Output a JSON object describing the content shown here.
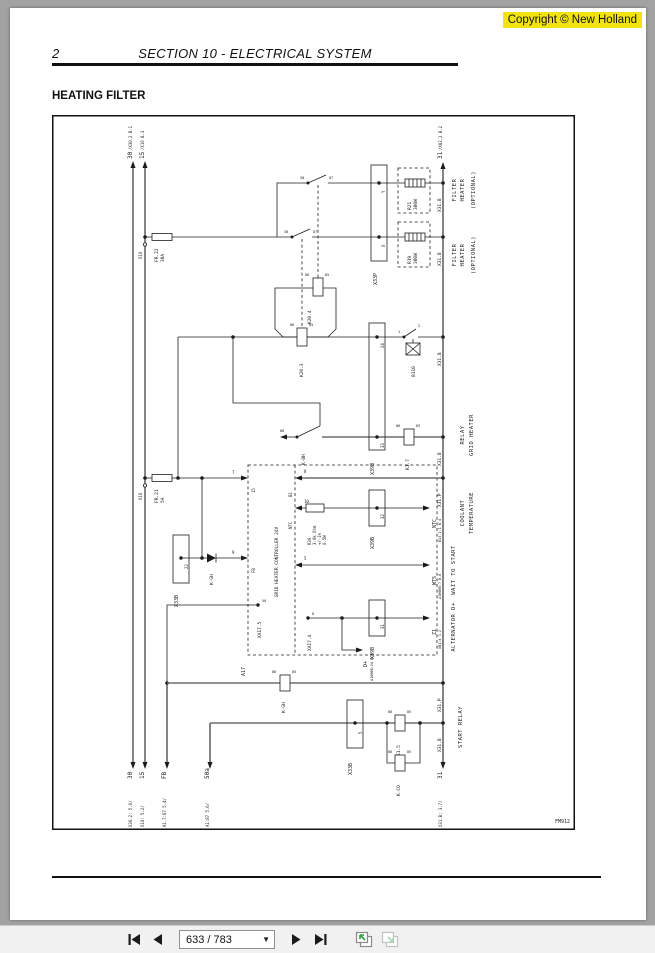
{
  "viewer": {
    "copyright": "Copyright © New Holland",
    "toolbar": {
      "page_field": "633 / 783"
    }
  },
  "doc": {
    "page_number": "2",
    "section_title": "SECTION 10 - ELECTRICAL SYSTEM",
    "heading": "HEATING FILTER",
    "figure_id": "FM912"
  },
  "d": {
    "rails": {
      "t30": "30",
      "t30r": "/X30.2 B.1",
      "t15": "15",
      "t15r": "/X10 B.3",
      "t31": "31",
      "t31r": "/X82.2 B.2",
      "b30r": "X30.2: 5.0/",
      "b30": "30",
      "b15r": "X10: 5.2/",
      "b15": "15",
      "bfbr": "A1.7:87 5.4/",
      "bfb": "FB",
      "b50r": "A1:87 5.6/",
      "b50": "50a",
      "b31r": "X31.B: 3.7/",
      "b31": "31"
    },
    "tags": {
      "x31b": "X31.B",
      "x31p": "X31.P",
      "x10": "X10"
    },
    "comp": {
      "fr22a": "FR.22",
      "fr22b": "30A",
      "fr21a": "FR.21",
      "fr21b": "5A",
      "x33p": "X33P",
      "pin_y": "Y",
      "pin_x": "X",
      "r21a": "R21",
      "r21b": "300W",
      "r19a": "R19",
      "r19b": "300W",
      "k20_4": "K20.4",
      "k20_3": "K20.3",
      "b110": "B110",
      "x39b": "X39B",
      "p24": "24",
      "p33": "33",
      "p32": "32",
      "p31": "31",
      "k1_7": "K1.7",
      "kbh": "K-BH",
      "kgh": "K-GH",
      "k1_5": "K1.5",
      "kco": "K-CO",
      "x33b": "X33B",
      "p22": "22",
      "p5": "5",
      "r30a": "R30",
      "r30b": "3.0k Ohm",
      "r30c": "+/-1%",
      "r30d": "0.5W",
      "a17": "A17",
      "ctrl": "GRID HEATER CONTROLLER 24V",
      "xa17_5": "XA17.5",
      "xa17_4": "XA17.4"
    },
    "pins": {
      "p86": "86",
      "p85": "85",
      "c30": "30",
      "c87": "87",
      "b1": "1",
      "b2": "2",
      "n7": "7",
      "n9": "9",
      "n8": "8",
      "n10": "10",
      "n5": "5",
      "s15": "15",
      "sfb": "FB",
      "sb1": "B1",
      "sntc": "NTC",
      "s50": "50",
      "sd": "D"
    },
    "refs": {
      "ntc": "NTC",
      "ntcr": "B13.1:1 B.4",
      "wts": "WTS",
      "wtsr": "A1000B:7 B.8",
      "z1": "Z1",
      "z1r": "XB1:4 3.2",
      "dp": "D+",
      "dpr": "A1000B:24 B.5"
    },
    "sec": {
      "fh1": "FILTER",
      "fh2": "HEATER",
      "fh3": "(OPTIONAL)",
      "rg1": "RELAY",
      "rg2": "GRID HEATER",
      "ct1": "COOLANT",
      "ct2": "TEMPERATURE",
      "wts": "WAIT TO START",
      "alt": "ALTERNATOR D+",
      "sr": "START RELAY"
    },
    "fig": "FM912"
  }
}
